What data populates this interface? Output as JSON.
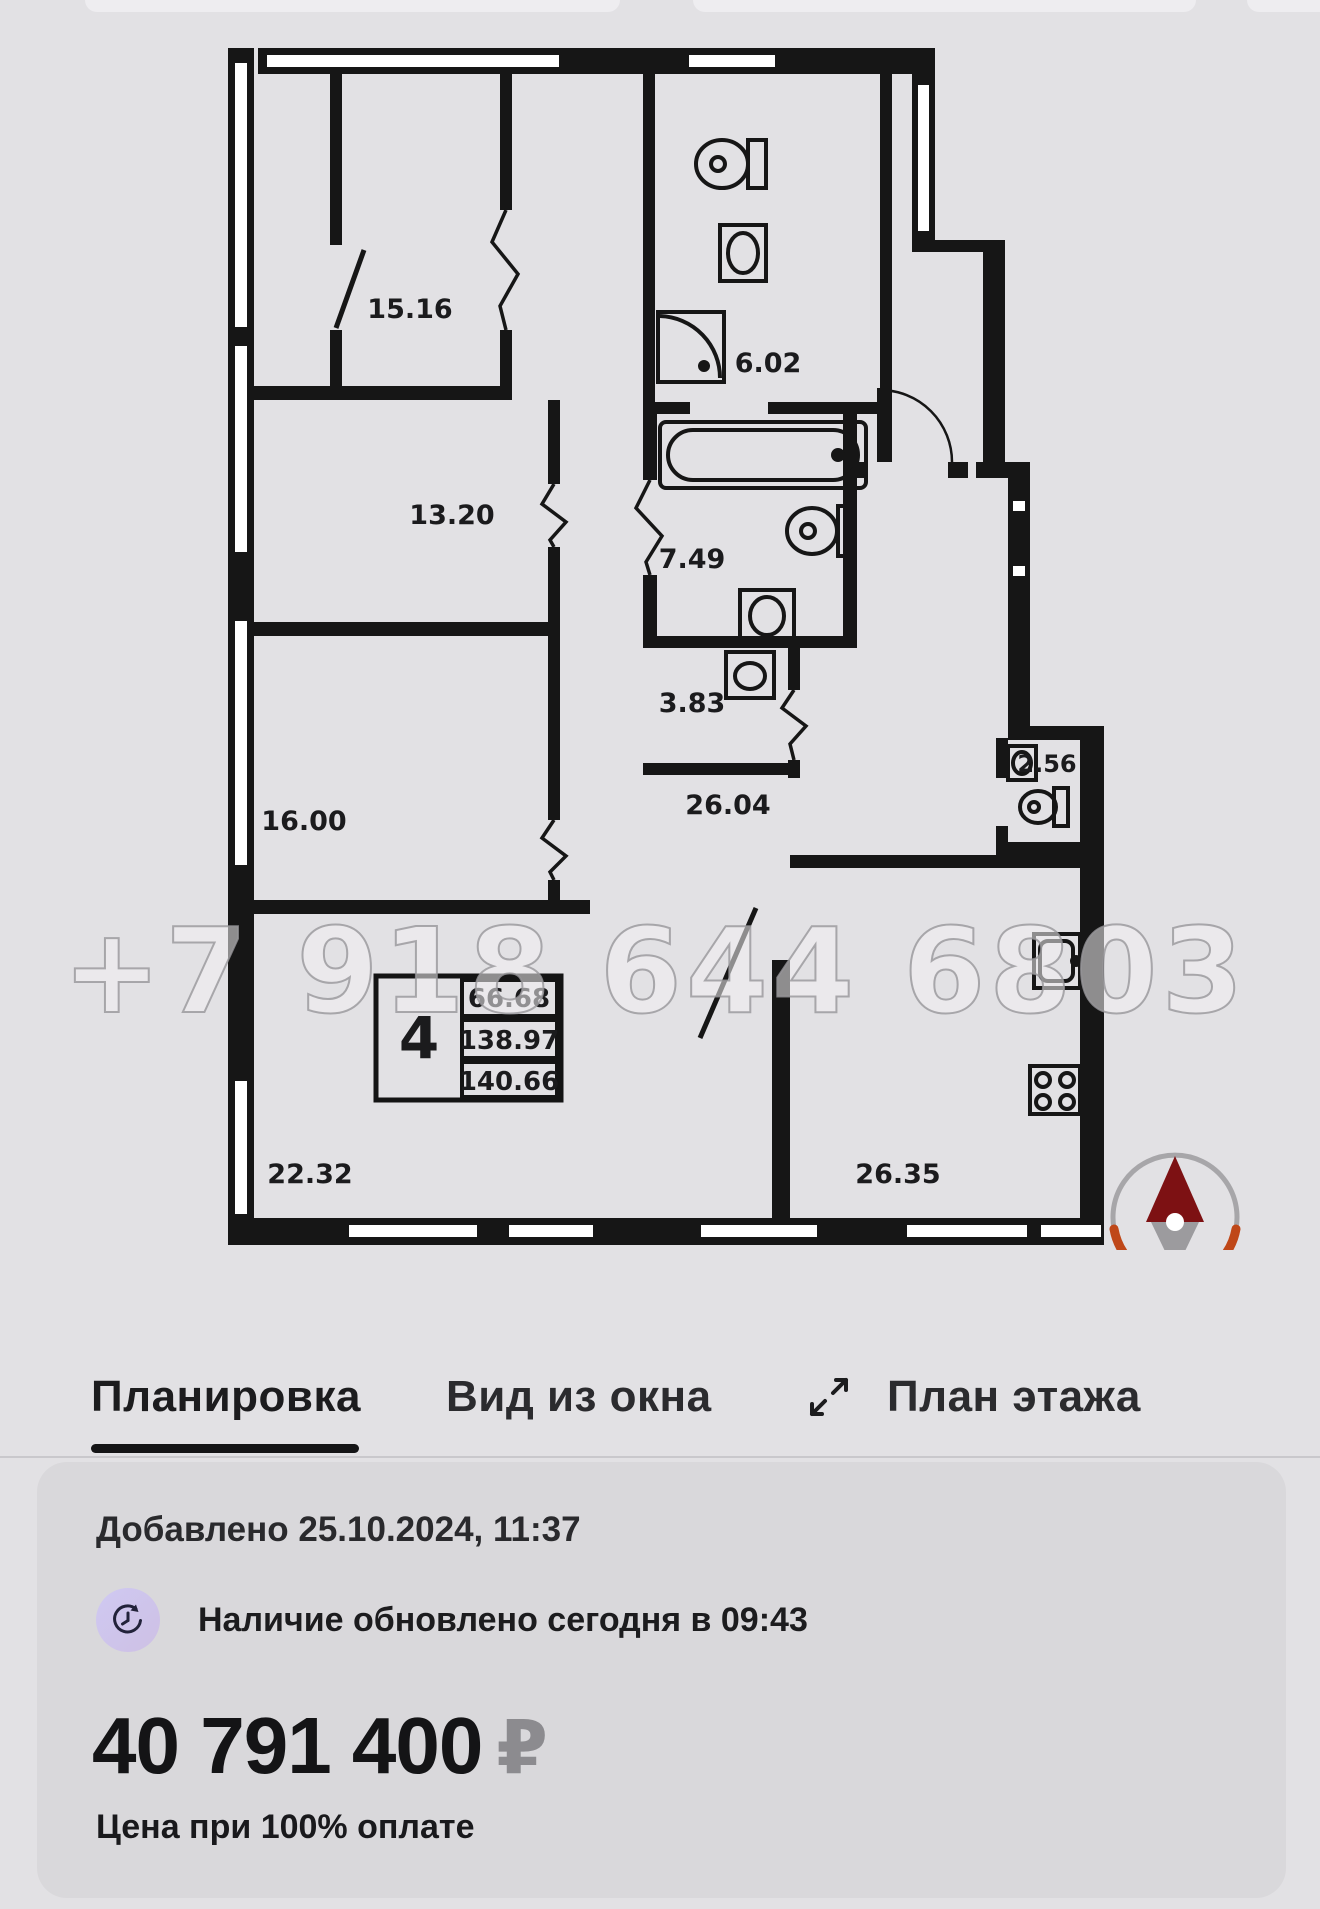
{
  "floor_plan": {
    "watermark": "+7 918 644 6803",
    "rooms": [
      {
        "label": "15.16"
      },
      {
        "label": "13.20"
      },
      {
        "label": "6.02"
      },
      {
        "label": "7.49"
      },
      {
        "label": "3.83"
      },
      {
        "label": "16.00"
      },
      {
        "label": "26.04"
      },
      {
        "label": "2.56"
      },
      {
        "label": "22.32"
      },
      {
        "label": "26.35"
      }
    ],
    "info_box": {
      "rooms_count": "4",
      "area_top": "66.68",
      "area_mid": "138.97",
      "area_bottom": "140.66"
    }
  },
  "tabs": [
    {
      "label": "Планировка",
      "active": true
    },
    {
      "label": "Вид из окна",
      "active": false
    },
    {
      "label": "План этажа",
      "active": false
    }
  ],
  "card": {
    "added": "Добавлено 25.10.2024, 11:37",
    "availability": "Наличие обновлено сегодня в 09:43",
    "price": "40 791 400",
    "currency": "₽",
    "price_note": "Цена при 100% оплате"
  },
  "colors": {
    "page_bg": "#e2e1e4",
    "card_bg": "#d9d8db",
    "wall": "#161616",
    "accent_tab": "#141416",
    "compass_orange": "#bf4718",
    "compass_red": "#7d1113",
    "clock_badge": "#cec5ec",
    "currency_gray": "#8c8b8f"
  }
}
